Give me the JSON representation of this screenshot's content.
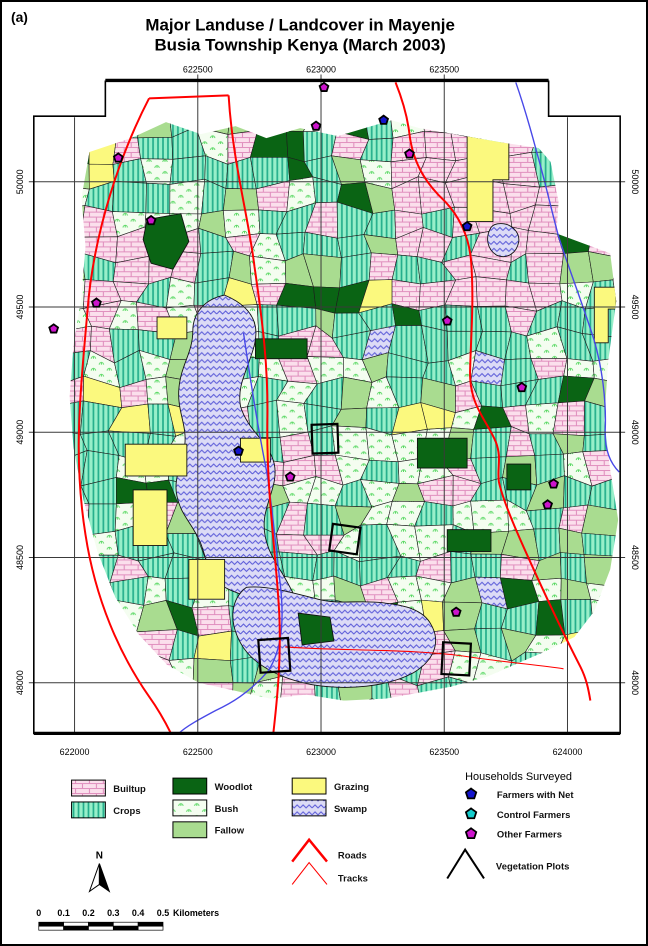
{
  "figure_label": "(a)",
  "title": {
    "line1": "Major Landuse / Landcover in Mayenje",
    "line2": "Busia Township Kenya (March 2003)"
  },
  "axes": {
    "top_labels": [
      {
        "text": "622500",
        "x": 197
      },
      {
        "text": "623000",
        "x": 321
      },
      {
        "text": "623500",
        "x": 445
      }
    ],
    "bottom_labels": [
      {
        "text": "622000",
        "x": 73
      },
      {
        "text": "622500",
        "x": 197
      },
      {
        "text": "623000",
        "x": 321
      },
      {
        "text": "623500",
        "x": 445
      },
      {
        "text": "624000",
        "x": 569
      }
    ],
    "left_labels": [
      {
        "text": "50000",
        "y": 180
      },
      {
        "text": "49500",
        "y": 306
      },
      {
        "text": "49000",
        "y": 432
      },
      {
        "text": "48500",
        "y": 558
      },
      {
        "text": "48000",
        "y": 684
      }
    ],
    "right_labels": [
      {
        "text": "50000",
        "y": 180
      },
      {
        "text": "49500",
        "y": 306
      },
      {
        "text": "49000",
        "y": 432
      },
      {
        "text": "48500",
        "y": 558
      },
      {
        "text": "48000",
        "y": 684
      }
    ]
  },
  "legend": {
    "landuse": [
      {
        "label": "Builtup",
        "key": "builtup"
      },
      {
        "label": "Crops",
        "key": "crops"
      },
      {
        "label": "Woodlot",
        "key": "woodlot"
      },
      {
        "label": "Bush",
        "key": "bush"
      },
      {
        "label": "Fallow",
        "key": "fallow"
      },
      {
        "label": "Grazing",
        "key": "grazing"
      },
      {
        "label": "Swamp",
        "key": "swamp"
      }
    ],
    "roads_label": "Roads",
    "tracks_label": "Tracks",
    "households": {
      "header": "Households Surveyed",
      "items": [
        {
          "label": "Farmers with Net",
          "color": "#1414cc"
        },
        {
          "label": "Control Farmers",
          "color": "#14cccc"
        },
        {
          "label": "Other Farmers",
          "color": "#cc14cc"
        }
      ],
      "vegetation_plots_label": "Vegetation Plots"
    }
  },
  "north_arrow_label": "N",
  "scale_bar": {
    "tick_labels": [
      "0",
      "0.1",
      "0.2",
      "0.3",
      "0.4",
      "0.5"
    ],
    "unit_label": "Kilometers"
  },
  "colors": {
    "builtup_base": "#fbdfec",
    "builtup_line": "#e08fbe",
    "crops_base": "#97efc9",
    "crops_line": "#23ae8b",
    "bush_base": "#f4fdf0",
    "bush_glyph": "#58d862",
    "fallow": "#a9dc90",
    "woodlot": "#0a6414",
    "grazing": "#fbf97e",
    "swamp_base": "#dcdbf6",
    "swamp_line": "#5b5bd8",
    "road": "#ff0000",
    "river": "#4848e8",
    "grid": "#3a3a3a",
    "frame": "#000000"
  },
  "map": {
    "markers": [
      {
        "type": "other",
        "x": 324,
        "y": 85
      },
      {
        "type": "other",
        "x": 316,
        "y": 124
      },
      {
        "type": "net",
        "x": 384,
        "y": 118
      },
      {
        "type": "other",
        "x": 117,
        "y": 156
      },
      {
        "type": "other",
        "x": 410,
        "y": 152
      },
      {
        "type": "other",
        "x": 150,
        "y": 219
      },
      {
        "type": "net",
        "x": 468,
        "y": 225
      },
      {
        "type": "other",
        "x": 95,
        "y": 302
      },
      {
        "type": "other",
        "x": 52,
        "y": 328
      },
      {
        "type": "other",
        "x": 448,
        "y": 320
      },
      {
        "type": "other",
        "x": 523,
        "y": 387
      },
      {
        "type": "net",
        "x": 238,
        "y": 451
      },
      {
        "type": "other",
        "x": 290,
        "y": 477
      },
      {
        "type": "other",
        "x": 555,
        "y": 484
      },
      {
        "type": "other",
        "x": 549,
        "y": 505
      },
      {
        "type": "other",
        "x": 457,
        "y": 613
      }
    ],
    "vegetation_plots": [
      {
        "x": 312,
        "y": 424,
        "w": 26,
        "h": 29,
        "rot": -2
      },
      {
        "x": 331,
        "y": 526,
        "w": 28,
        "h": 27,
        "rot": 8
      },
      {
        "x": 443,
        "y": 644,
        "w": 28,
        "h": 32,
        "rot": 3
      },
      {
        "x": 259,
        "y": 640,
        "w": 30,
        "h": 33,
        "rot": -4
      }
    ]
  }
}
